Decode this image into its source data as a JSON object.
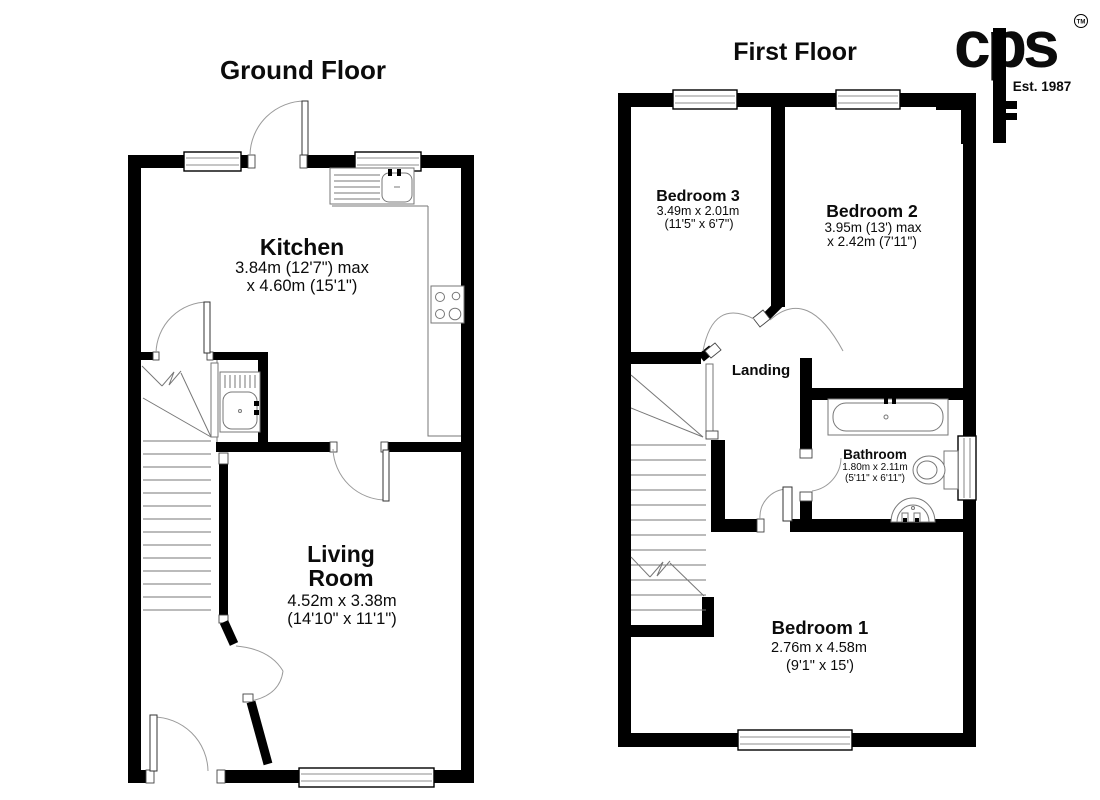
{
  "titles": {
    "ground_floor": "Ground Floor",
    "first_floor": "First Floor"
  },
  "logo": {
    "brand": "cps",
    "trademark": "TM",
    "established": "Est. 1987"
  },
  "ground_floor": {
    "kitchen": {
      "name": "Kitchen",
      "dim_metric": "3.84m (12'7\") max",
      "dim_imperial": "x 4.60m (15'1\")"
    },
    "living_room": {
      "name_line1": "Living",
      "name_line2": "Room",
      "dim_metric": "4.52m x 3.38m",
      "dim_imperial": "(14'10\" x 11'1\")"
    }
  },
  "first_floor": {
    "bedroom3": {
      "name": "Bedroom 3",
      "dim_metric": "3.49m x 2.01m",
      "dim_imperial": "(11'5\" x 6'7\")"
    },
    "bedroom2": {
      "name": "Bedroom 2",
      "dim_metric": "3.95m (13') max",
      "dim_imperial": "x 2.42m (7'11\")"
    },
    "landing": {
      "name": "Landing"
    },
    "bathroom": {
      "name": "Bathroom",
      "dim_metric": "1.80m x 2.11m",
      "dim_imperial": "(5'11\" x 6'11\")"
    },
    "bedroom1": {
      "name": "Bedroom 1",
      "dim_metric": "2.76m x 4.58m",
      "dim_imperial": "(9'1\" x 15')"
    }
  },
  "colors": {
    "wall": "#000000",
    "fixture_line": "#777777",
    "arc_line": "#999999",
    "background": "#ffffff"
  }
}
